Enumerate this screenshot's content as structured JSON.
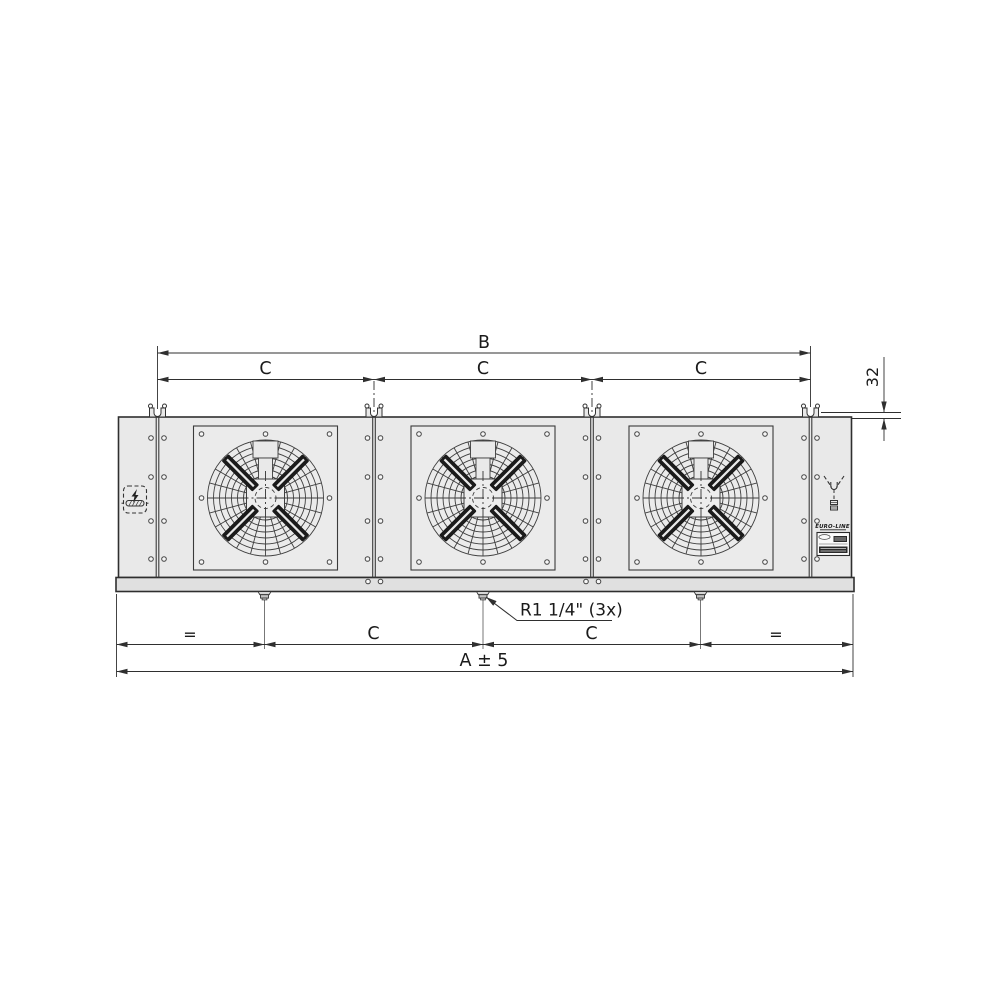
{
  "dimensions": {
    "b": "B",
    "c": "C",
    "offset_32": "32",
    "equal": "=",
    "overall_a": "A ± 5",
    "drain_callout": "R1 1/4\" (3x)"
  },
  "branding": {
    "logo": "EURO-LINE"
  },
  "colors": {
    "casing_fill": "#e9e9e9",
    "flange_fill": "#e0e0e0",
    "line": "#2f2f2f",
    "blade": "#1b1b1b"
  }
}
